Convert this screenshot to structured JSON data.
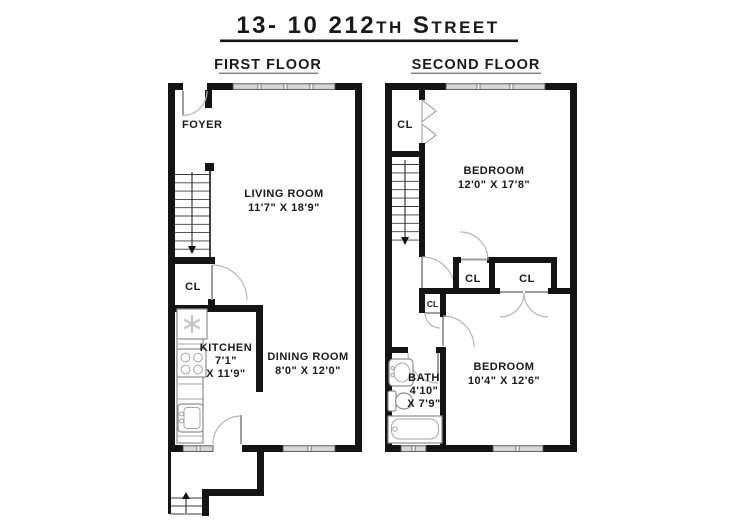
{
  "title": "13- 10 212th Street",
  "first_floor": {
    "label": "FIRST FLOOR",
    "foyer": "FOYER",
    "living_room": {
      "name": "LIVING ROOM",
      "dims": "11'7\" X 18'9\""
    },
    "closet": "CL",
    "kitchen": {
      "name": "KITCHEN",
      "dim1": "7'1\"",
      "dim2": "X 11'9\""
    },
    "dining_room": {
      "name": "DINING ROOM",
      "dims": "8'0\" X 12'0\""
    }
  },
  "second_floor": {
    "label": "SECOND FLOOR",
    "closet_top": "CL",
    "bedroom_1": {
      "name": "BEDROOM",
      "dims": "12'0\" X 17'8\""
    },
    "closet_left": "CL",
    "closet_right": "CL",
    "closet_small": "CL",
    "bath": {
      "name": "BATH",
      "dim1": "4'10\"",
      "dim2": "X 7'9\""
    },
    "bedroom_2": {
      "name": "BEDROOM",
      "dims": "10'4\" X 12'6\""
    }
  },
  "colors": {
    "wall": "#141414",
    "window_fill": "#d7d7d7",
    "door": "#9d9d9d",
    "text": "#1a1a1a",
    "background": "#ffffff"
  }
}
